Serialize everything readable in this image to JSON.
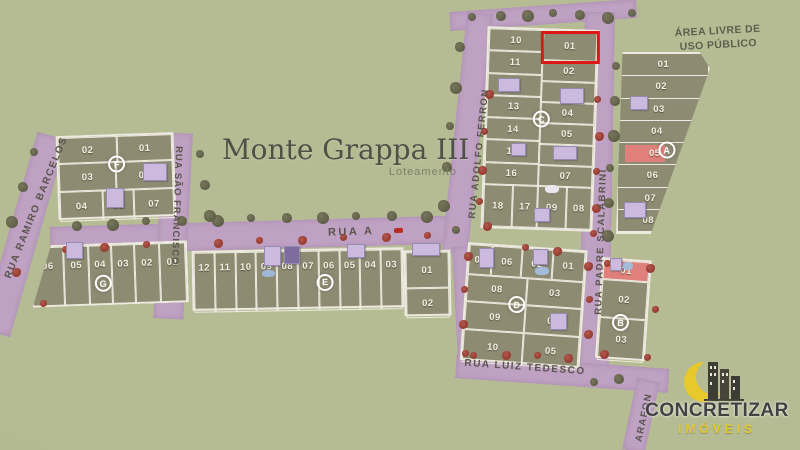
{
  "title": {
    "text": "Monte Grappa III",
    "subtitle": "Loteamento"
  },
  "public_area": {
    "line1": "ÁREA LIVRE DE",
    "line2": "USO PÚBLICO"
  },
  "streets": {
    "rua_a": "RUA A",
    "ramiro_barcelos": "RUA RAMIRO BARCELOS",
    "sao_francisco": "RUA SÃO FRANCISCO",
    "adolfo_ferron": "RUA ADOLFO FERRON",
    "padre_scalabrini": "RUA PADRE SCALABRINI",
    "luiz_tedesco": "RUA LUIZ TEDESCO",
    "arafon": "ARAFON"
  },
  "blocks": {
    "F": {
      "letter": "F",
      "rows": [
        [
          "02",
          "01"
        ],
        [
          "03",
          "06"
        ],
        [
          "04",
          "05",
          "07"
        ]
      ]
    },
    "G": {
      "letter": "G",
      "rows": [
        [
          "06",
          "05",
          "04",
          "03",
          "02",
          "01"
        ]
      ]
    },
    "E": {
      "letter": "E",
      "rows": [
        [
          "12",
          "11",
          "10",
          "09",
          "08",
          "07",
          "06",
          "05",
          "04",
          "03"
        ]
      ]
    },
    "E_east": {
      "letter": "",
      "rows": [
        [
          "01"
        ],
        [
          "02"
        ]
      ]
    },
    "C": {
      "letter": "C",
      "left_column": [
        "10",
        "11",
        "12",
        "13",
        "14",
        "15",
        "16"
      ],
      "right_column": [
        "01",
        "02",
        "03",
        "04",
        "05",
        "06",
        "07"
      ],
      "bottom_row": [
        "18",
        "17",
        "09",
        "08"
      ],
      "highlighted_lot": "01"
    },
    "A": {
      "letter": "A",
      "lots": [
        "01",
        "02",
        "03",
        "04",
        "05",
        "06",
        "07",
        "08"
      ],
      "pink_lot": "05"
    },
    "D": {
      "letter": "D",
      "rows": [
        [
          "07",
          "06",
          "02",
          "01"
        ],
        [
          "08",
          "03"
        ],
        [
          "09",
          "04"
        ],
        [
          "10",
          "05"
        ]
      ]
    },
    "B": {
      "letter": "B",
      "lots": [
        "01",
        "02",
        "03"
      ],
      "pink_lot": "01"
    }
  },
  "highlight": {
    "block": "C",
    "lot": "01",
    "color": "#df1614"
  },
  "logo": {
    "brand": "CONCRETIZAR",
    "subbrand": "IMÓVEIS"
  },
  "colors": {
    "background": "#b5bc93",
    "street": "#bfa1c3",
    "lot": "#8e8b73",
    "line": "#edeadf",
    "red": "#df1614",
    "pink": "#e0807a",
    "building": "#cbbade",
    "title": "#4e5145",
    "street_label": "#59544c",
    "logo_text": "#414141",
    "logo_yellow": "#e8c92b"
  }
}
